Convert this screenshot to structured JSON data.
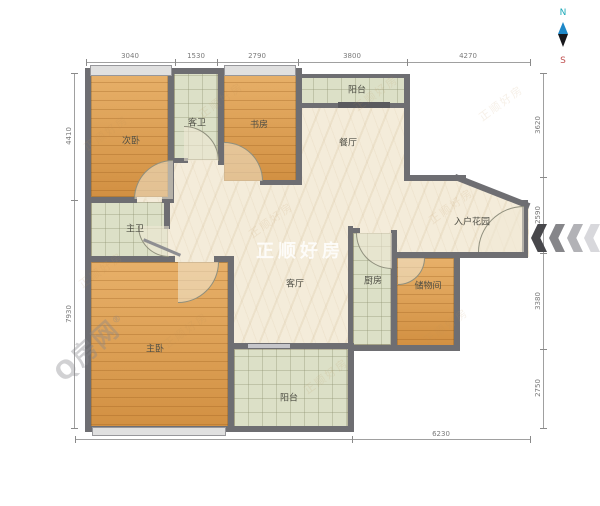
{
  "compass": {
    "north": "N",
    "south": "S"
  },
  "rooms": {
    "ciwo": {
      "label": "次卧"
    },
    "kewei": {
      "label": "客卫"
    },
    "shufang": {
      "label": "书房"
    },
    "yangtai_top": {
      "label": "阳台"
    },
    "canting": {
      "label": "餐厅"
    },
    "ruhu": {
      "label": "入户花园"
    },
    "zhuwei": {
      "label": "主卫"
    },
    "keting": {
      "label": "客厅"
    },
    "chufang": {
      "label": "厨房"
    },
    "chuwu": {
      "label": "储物间"
    },
    "zhuwo": {
      "label": "主卧"
    },
    "yangtai_bottom": {
      "label": "阳台"
    }
  },
  "dims": {
    "top": [
      "3040",
      "1530",
      "2790",
      "3800",
      "4270"
    ],
    "left": [
      "4410",
      "7930"
    ],
    "right": [
      "3620",
      "2590",
      "3380",
      "2750"
    ],
    "bottom": [
      "9200",
      "6230"
    ]
  },
  "watermarks": {
    "center": "正顺好房",
    "brand": "Q房网",
    "reg": "®",
    "tiled": "正顺好房"
  },
  "palette": {
    "wall": "#6e6e72",
    "wood_floor": "#dd9b4b",
    "tile_floor": "#dce0c7",
    "marble_floor": "#f4ecda",
    "north_label": "#1ba8b8",
    "south_label": "#c05050",
    "needle_top": "#1e88c8",
    "needle_bottom": "#17171b",
    "arrow_darkest": "#48484c",
    "arrow_lightest": "#d8d8dc"
  }
}
